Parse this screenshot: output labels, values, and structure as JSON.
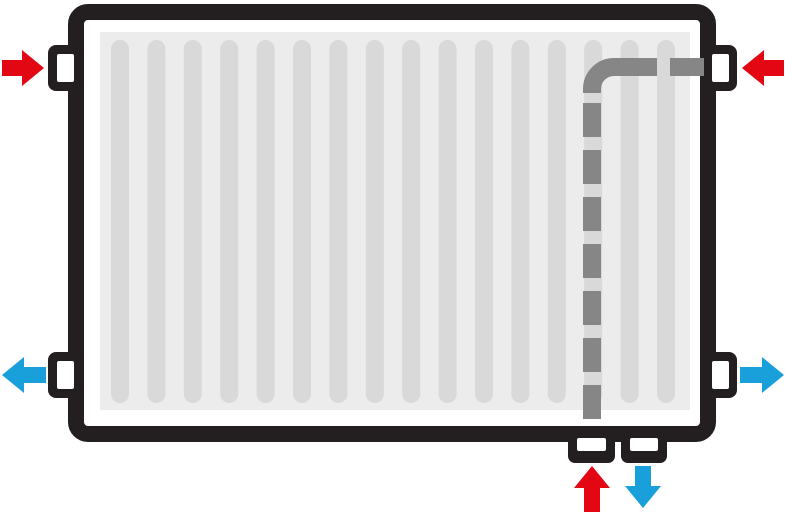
{
  "diagram": {
    "description": "Radiator flow schematic: red arrows entering at top-left, top-right and bottom-center; blue arrows leaving at bottom-left, bottom-right and bottom-center; dashed grey internal pipe from the top-right port down to the bottom-center-left port",
    "colors": {
      "background": "#ffffff",
      "frame": "#231f20",
      "panel": "#ececec",
      "rib": "#d9d9d9",
      "pipe": "#868686",
      "hot": "#e30613",
      "cold": "#199fda",
      "port": "#ffffff"
    },
    "ribs": {
      "count": 16
    },
    "arrows": [
      {
        "name": "red-arrow-top-left",
        "direction": "right",
        "color_role": "hot"
      },
      {
        "name": "red-arrow-top-right",
        "direction": "left",
        "color_role": "hot"
      },
      {
        "name": "blue-arrow-bottom-left",
        "direction": "left",
        "color_role": "cold"
      },
      {
        "name": "blue-arrow-bottom-right",
        "direction": "right",
        "color_role": "cold"
      },
      {
        "name": "red-arrow-bottom-center",
        "direction": "up",
        "color_role": "hot"
      },
      {
        "name": "blue-arrow-bottom-center",
        "direction": "down",
        "color_role": "cold"
      }
    ],
    "ports": {
      "side": [
        "top-left",
        "top-right",
        "bottom-left",
        "bottom-right"
      ],
      "bottom": [
        "bottom-center-left",
        "bottom-center-right"
      ]
    },
    "pipe": {
      "style": "dashed",
      "route": "top-right side port, horizontal left, elbow, vertical down to bottom-center-left port"
    }
  }
}
